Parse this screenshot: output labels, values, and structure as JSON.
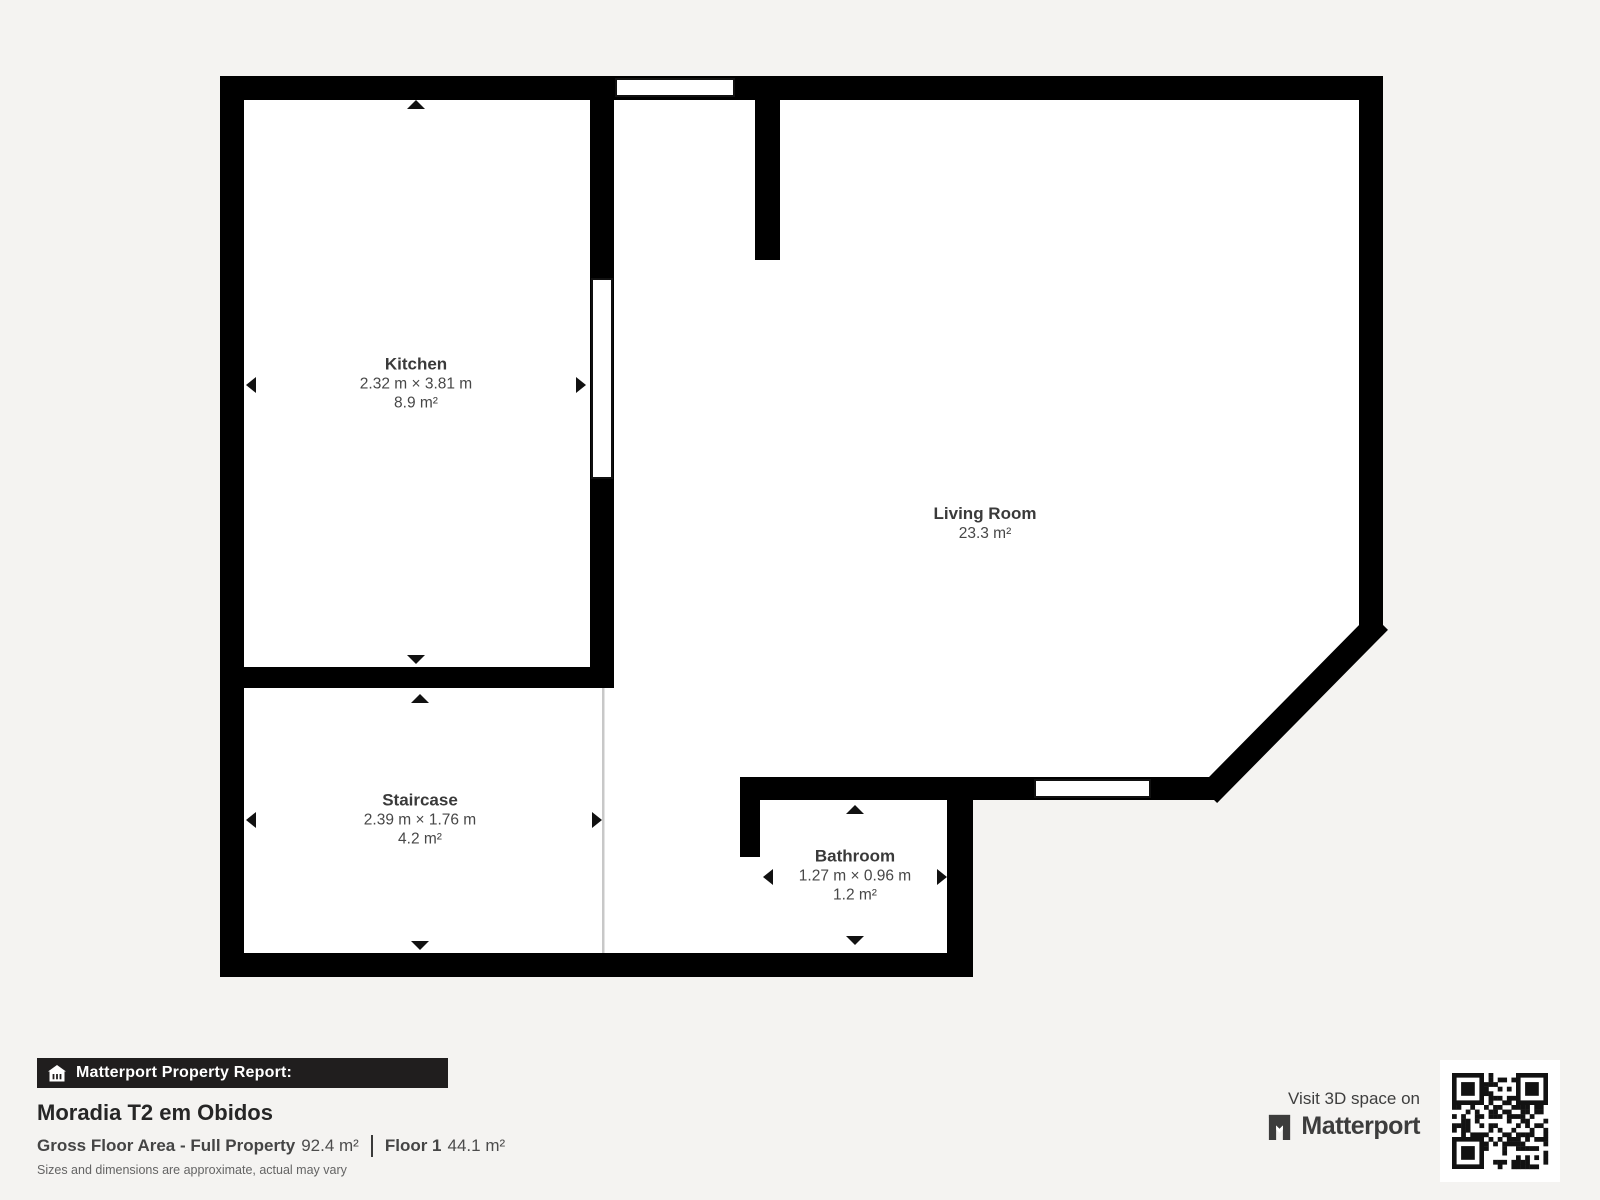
{
  "plan": {
    "rooms": [
      {
        "name": "Kitchen",
        "dimensions": "2.32 m × 3.81 m",
        "area": "8.9 m²"
      },
      {
        "name": "Living Room",
        "area": "23.3 m²"
      },
      {
        "name": "Staircase",
        "dimensions": "2.39 m × 1.76 m",
        "area": "4.2 m²"
      },
      {
        "name": "Bathroom",
        "dimensions": "1.27 m × 0.96 m",
        "area": "1.2 m²"
      }
    ],
    "icons": {
      "windows": "window-opening",
      "arrows": "dimension-arrow"
    }
  },
  "footer": {
    "report_bar_label": "Matterport Property Report:",
    "report_bar_icon": "house-icon",
    "property_title": "Moradia T2 em Obidos",
    "gross_floor_label": "Gross Floor Area - Full Property",
    "gross_floor_value": "92.4 m²",
    "floor_label": "Floor 1",
    "floor_value": "44.1 m²",
    "disclaimer": "Sizes and dimensions are approximate, actual may vary"
  },
  "promo": {
    "visit_text": "Visit 3D space on",
    "brand_name": "Matterport",
    "brand_icon": "matterport-m-icon",
    "qr_icon": "qr-code"
  },
  "colors": {
    "background": "#f4f3f1",
    "wall": "#000000",
    "room_fill": "#ffffff",
    "bar_bg": "#201e1e",
    "text_dark": "#262626",
    "text_gray": "#4c4c4c"
  }
}
